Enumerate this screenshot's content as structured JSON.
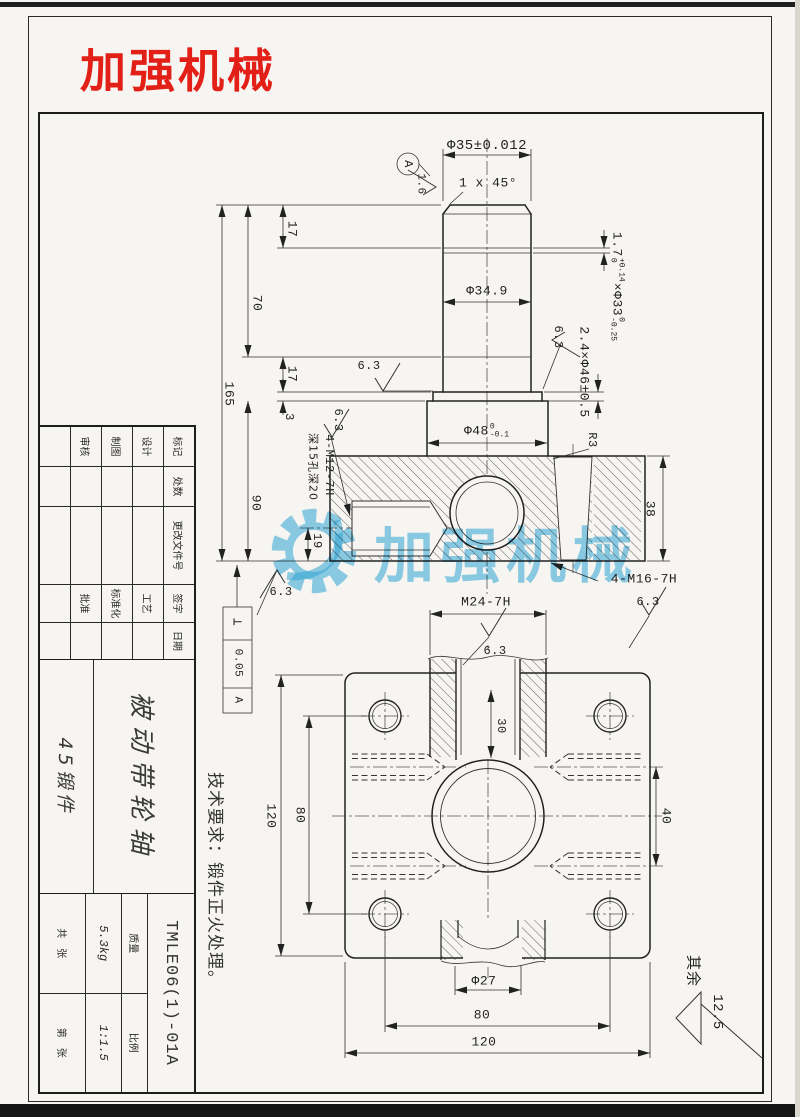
{
  "logo": {
    "text": "加强机械",
    "color": "#e32017"
  },
  "watermark": {
    "text": "加强机械",
    "color": "#38aee0"
  },
  "notes": {
    "tech": "技术要求：锻件正火处理。",
    "rest_label": "其余",
    "rest_value": "12.5"
  },
  "shaft_view": {
    "dia_top": "Φ35±0.012",
    "chamfer": "1 x 45°",
    "datum": "A",
    "rough_16": "1.6",
    "rough_63": "6.3",
    "groove_top": {
      "pre": "1.7",
      "up": "+0.14",
      "dn": "0",
      "mid": "×Φ33",
      "up2": "0",
      "dn2": "-0.25"
    },
    "groove_mid": "2.4×Φ46±0.5",
    "dia_mid": "Φ34.9",
    "collar": {
      "pre": "Φ48",
      "up": "0",
      "dn": "-0.1"
    },
    "fillet": "R3",
    "len_165": "165",
    "len_70": "70",
    "len_17a": "17",
    "len_17b": "17",
    "len_3": "3",
    "len_90": "90",
    "len_19": "19",
    "len_38": "38",
    "thread_m16": "4-M16-7H",
    "thread_m12": "4-M12-7H",
    "thread_m12_note": "深15孔深20",
    "perp": {
      "sym": "⊥",
      "val": "0.05",
      "ref": "A"
    }
  },
  "flange_view": {
    "thread_m24": "M24-7H",
    "depth_30": "30",
    "left_120": "120",
    "left_80": "80",
    "right_40": "40",
    "dia_27": "Φ27",
    "bottom_80": "80",
    "bottom_120": "120"
  },
  "title_block": {
    "change_headers": [
      "标记",
      "处数",
      "更改文件号",
      "签字",
      "日期"
    ],
    "row_labels": [
      "设计",
      "制图",
      "审核"
    ],
    "row_labels2": [
      "工艺",
      "标准化",
      "批准"
    ],
    "part_name": "被动带轮轴",
    "material": "45锻件",
    "drawing_no": "TMLE06(1)-01A",
    "mass_label": "质量",
    "mass_value": "5.3kg",
    "scale_label": "比例",
    "scale_value": "1:1.5",
    "sheet_total": "共　张",
    "sheet_no": "第　张"
  }
}
